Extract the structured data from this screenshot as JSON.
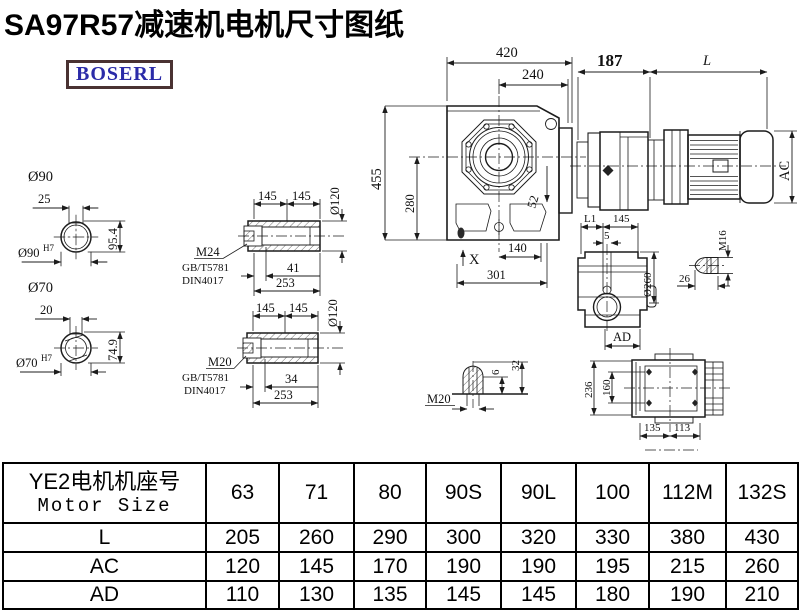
{
  "title": "SA97R57减速机电机尺寸图纸",
  "logo": {
    "text": "BOSERL"
  },
  "drawing": {
    "shaft_top": {
      "dia": "Ø90",
      "key_w": "25",
      "key_h": "95.4",
      "fit": "Ø90",
      "fit_sup": "H7"
    },
    "shaft_bottom": {
      "dia": "Ø70",
      "key_w": "20",
      "key_h": "74.9",
      "fit": "Ø70",
      "fit_sup": "H7"
    },
    "sleeve_top": {
      "len_a": "145",
      "len_b": "145",
      "od": "Ø120",
      "thread": "M24",
      "std1": "GB/T5781",
      "std2": "DIN4017",
      "depth": "41",
      "total": "253"
    },
    "sleeve_bottom": {
      "len_a": "145",
      "len_b": "145",
      "od": "Ø120",
      "thread": "M20",
      "std1": "GB/T5781",
      "std2": "DIN4017",
      "depth": "34",
      "total": "253"
    },
    "front": {
      "width": "420",
      "to_center": "240",
      "height": "455",
      "center_h": "280",
      "angle": "52",
      "x_mark": "X",
      "foot": "140",
      "base": "301"
    },
    "motor": {
      "adapter": "187",
      "length": "L",
      "dia": "AC"
    },
    "side": {
      "l1": "L1",
      "top": "145",
      "offset": "5",
      "flange": "Ø260",
      "width": "AD"
    },
    "bolt_m16": {
      "thread": "M16",
      "length": "26"
    },
    "bolt_m20": {
      "thread": "M20",
      "proud": "6",
      "height": "32"
    },
    "rear": {
      "height": "236",
      "bolt_v": "160",
      "bolt_h1": "135",
      "bolt_h2": "113"
    }
  },
  "table": {
    "header_cn": "YE2电机机座号",
    "header_en": "Motor Size",
    "columns": [
      "63",
      "71",
      "80",
      "90S",
      "90L",
      "100",
      "112M",
      "132S"
    ],
    "rows": [
      {
        "label": "L",
        "values": [
          "205",
          "260",
          "290",
          "300",
          "320",
          "330",
          "380",
          "430"
        ]
      },
      {
        "label": "AC",
        "values": [
          "120",
          "145",
          "170",
          "190",
          "190",
          "195",
          "215",
          "260"
        ]
      },
      {
        "label": "AD",
        "values": [
          "110",
          "130",
          "135",
          "145",
          "145",
          "180",
          "190",
          "210"
        ]
      }
    ]
  }
}
